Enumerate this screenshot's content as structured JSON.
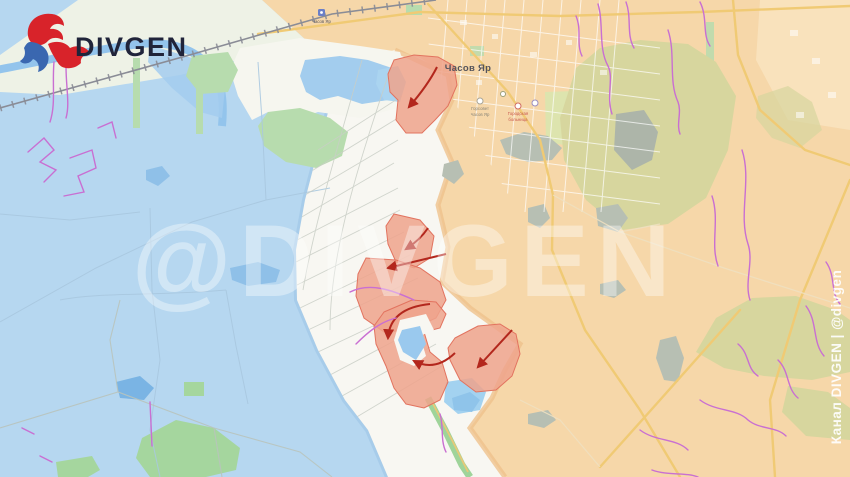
{
  "brand": {
    "logo_text": "DIVGEN"
  },
  "watermark": {
    "center_text": "@DIVGEN",
    "side_text": "Канал DIVGEN | @divgen"
  },
  "map": {
    "labels": {
      "town": "Часов Яр",
      "station": "Часов Яр",
      "gorsovet_line1": "Горсовет",
      "gorsovet_line2": "Часов Яр",
      "hospital_line1": "Городская",
      "hospital_line2": "больница"
    }
  },
  "colors": {
    "blue_zone": "#b6d7f0",
    "orange_zone": "#f6d7a9",
    "neutral_zone": "#f8f7f2",
    "canal_band": "#eef2e6",
    "advance_fill": "#efa38c",
    "advance_stroke": "#e2735f",
    "arrow": "#b3271d",
    "trench": "#c96fd2",
    "water": "#9ac9ee",
    "water_deep": "#7ab4e4",
    "pond_grey": "#b7bfb3",
    "park": "#b7dcae",
    "olive": "#d7d69e",
    "road_yellow": "#f0ca74",
    "railway": "#8a8c96",
    "watermark_color": "#ffffff",
    "side_text_color": "#ffffff",
    "logo_red": "#d8232a",
    "logo_blue": "#3a67b0",
    "logo_text_color": "#20243a",
    "town_label_color": "#54545c",
    "poi_red": "#c85a50",
    "poi_grey": "#8a8578"
  }
}
